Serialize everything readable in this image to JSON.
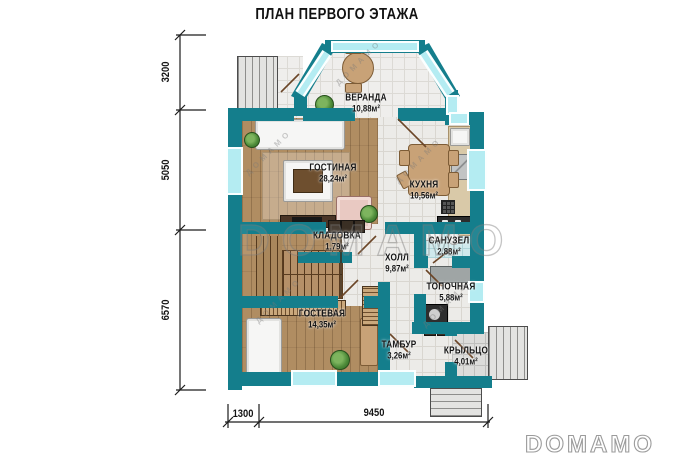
{
  "title": "ПЛАН ПЕРВОГО ЭТАЖА",
  "rooms": [
    {
      "name": "ВЕРАНДА",
      "area": "10,88м²"
    },
    {
      "name": "ГОСТИНАЯ",
      "area": "28,24м²"
    },
    {
      "name": "КУХНЯ",
      "area": "10,56м²"
    },
    {
      "name": "КЛАДОВКА",
      "area": "1,79м²"
    },
    {
      "name": "ХОЛЛ",
      "area": "9,87м²"
    },
    {
      "name": "САНУЗЕЛ",
      "area": "2,88м²"
    },
    {
      "name": "ТОПОЧНАЯ",
      "area": "5,88м²"
    },
    {
      "name": "ГОСТЕВАЯ",
      "area": "14,35м²"
    },
    {
      "name": "ТАМБУР",
      "area": "3,26м²"
    },
    {
      "name": "КРЫЛЬЦО",
      "area": "4,01м²"
    }
  ],
  "dimensions": {
    "left": [
      "3200",
      "5050",
      "6570"
    ],
    "bottom": [
      "1300",
      "9450"
    ]
  },
  "watermarks": {
    "center": "DOMAMO",
    "corner": "DOMAMO",
    "diagonal": "ДОМАМО"
  },
  "colors": {
    "wall": "#147e8c",
    "window": "#b4ecf2",
    "wood": "#b08d62",
    "tile": "#ecebe8"
  }
}
